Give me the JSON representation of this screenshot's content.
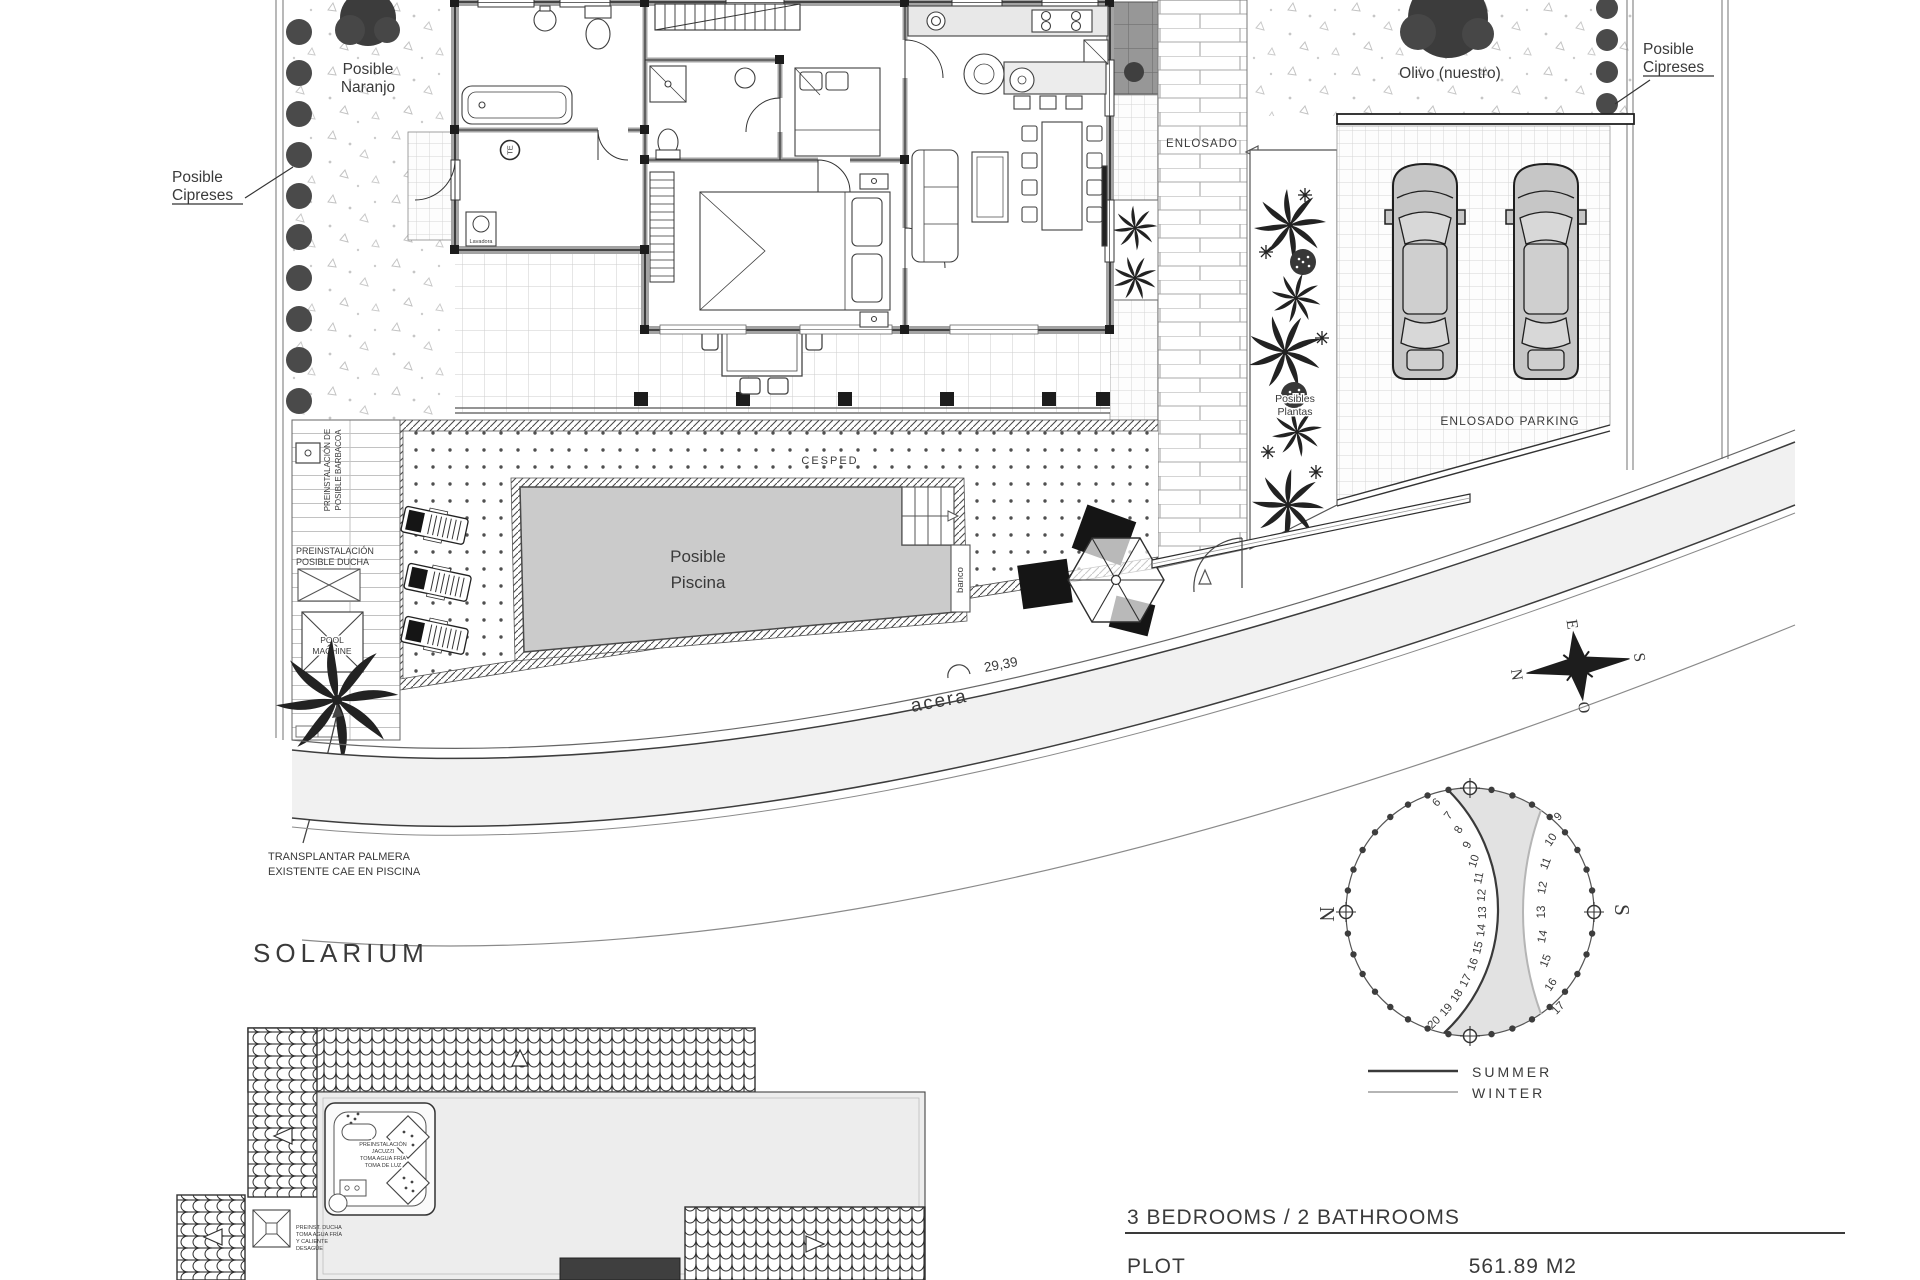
{
  "footer": {
    "rooms": "3 BEDROOMS / 2 BATHROOMS",
    "plot_label": "PLOT",
    "plot_area": "561.89 M2"
  },
  "solarium": {
    "title": "SOLARIUM",
    "jacuzzi_note": [
      "PREINSTALACIÓN",
      "JACUZZI",
      "TOMA AGUA FRÍA",
      "TOMA DE LUZ"
    ],
    "shower_note": [
      "PREINST. DUCHA",
      "TOMA AGUA FRÍA",
      "Y CALIENTE",
      "DESAGÜE"
    ]
  },
  "site": {
    "posible_naranjo": [
      "Posible",
      "Naranjo"
    ],
    "posible_cipreses": [
      "Posible",
      "Cipreses"
    ],
    "olivo": "Olivo (nuestro)",
    "enlosado": "ENLOSADO",
    "enlosado_parking": "ENLOSADO PARKING",
    "posibles_plantas": [
      "Posibles",
      "Plantas"
    ],
    "cesped": "CESPED",
    "posible_piscina": [
      "Posible",
      "Piscina"
    ],
    "banco": "banco",
    "acera": "acera",
    "street_dim": "29,39",
    "pool_machine": [
      "POOL",
      "MACHINE"
    ],
    "pre_ducha": [
      "PREINSTALACIÓN",
      "POSIBLE DUCHA"
    ],
    "pre_barbacoa": [
      "PREINSTALACIÓN DE",
      "POSIBLE BARBACOA"
    ],
    "transplantar": [
      "TRANSPLANTAR PALMERA",
      "EXISTENTE  CAE EN PISCINA"
    ],
    "lavadora": "Lavadora",
    "te": "TE"
  },
  "compass": {
    "n": "N",
    "e": "E",
    "s": "S",
    "w": "O"
  },
  "sun_diagram": {
    "north": "N",
    "south": "S",
    "summer_hours": [
      6,
      7,
      8,
      9,
      10,
      11,
      12,
      13,
      14,
      15,
      16,
      17,
      18,
      19,
      20
    ],
    "winter_hours": [
      9,
      10,
      11,
      12,
      13,
      14,
      15,
      16,
      17
    ],
    "legend_summer": "SUMMER",
    "legend_winter": "WINTER",
    "summer_color": "#3a3a3a",
    "winter_color": "#b5b5b5",
    "shade_color": "#e2e2e2"
  },
  "trees": {
    "cypress_left_count": 10,
    "cypress_right_count": 4,
    "patio_cypress_count": 1
  }
}
